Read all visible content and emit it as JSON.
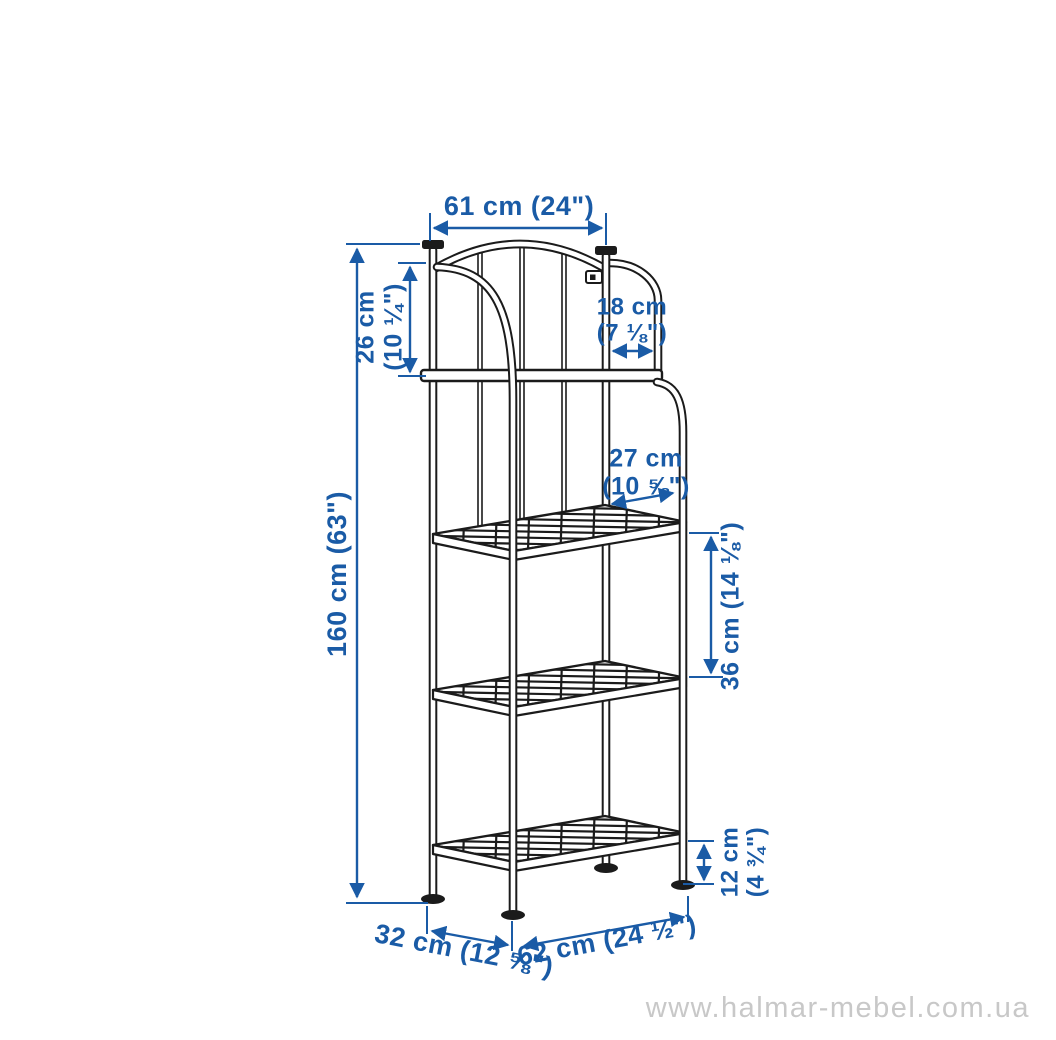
{
  "canvas": {
    "width": 1056,
    "height": 1040,
    "background": "#ffffff"
  },
  "colors": {
    "dimension_blue": "#1a5ba6",
    "line_art_black": "#1b1b1b",
    "watermark_gray": "#c8c8c8"
  },
  "dimensions": {
    "top_width": {
      "text": "61 cm (24\")"
    },
    "top_section_height": {
      "line1": "26 cm",
      "line2": "(10 ¼\")"
    },
    "top_side_opening": {
      "line1": "18 cm",
      "line2": "(7 ⅛\")"
    },
    "side_clearance": {
      "line1": "27 cm",
      "line2": "(10 ⅝\")"
    },
    "total_height": {
      "text": "160 cm (63\")"
    },
    "shelf_spacing": {
      "text": "36 cm (14 ⅛\")"
    },
    "bottom_clearance": {
      "line1": "12 cm",
      "line2": "(4 ¾\")"
    },
    "base_depth": {
      "text": "32 cm (12 ⅝\")"
    },
    "base_width": {
      "text": "62 cm (24 ½\")"
    }
  },
  "watermark": {
    "text": "www.halmar-mebel.com.ua"
  }
}
